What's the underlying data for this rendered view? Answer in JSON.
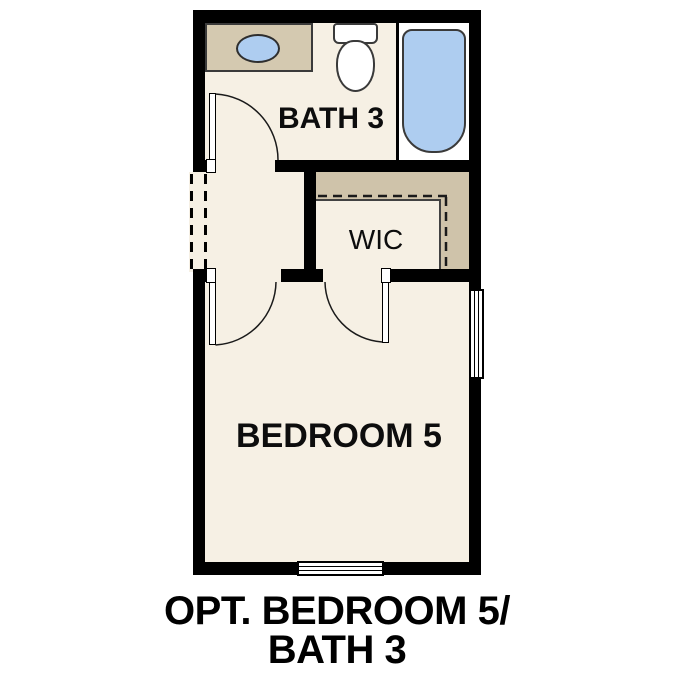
{
  "floorplan": {
    "rooms": {
      "bath": {
        "label": "BATH 3"
      },
      "wic": {
        "label": "WIC"
      },
      "bedroom": {
        "label": "BEDROOM 5"
      }
    },
    "caption": {
      "line1": "OPT. BEDROOM 5/",
      "line2": "BATH 3"
    },
    "fixtures": [
      "vanity-sink",
      "toilet",
      "bathtub"
    ],
    "colors": {
      "wall": "#000000",
      "floor": "#f6f0e4",
      "vanity_tan": "#d4c9b0",
      "closet_tan": "#cfc3aa",
      "fixture_blue": "#aecdf0",
      "tub_area_white": "#ffffff",
      "outline_dark": "#3a3a3a"
    }
  }
}
